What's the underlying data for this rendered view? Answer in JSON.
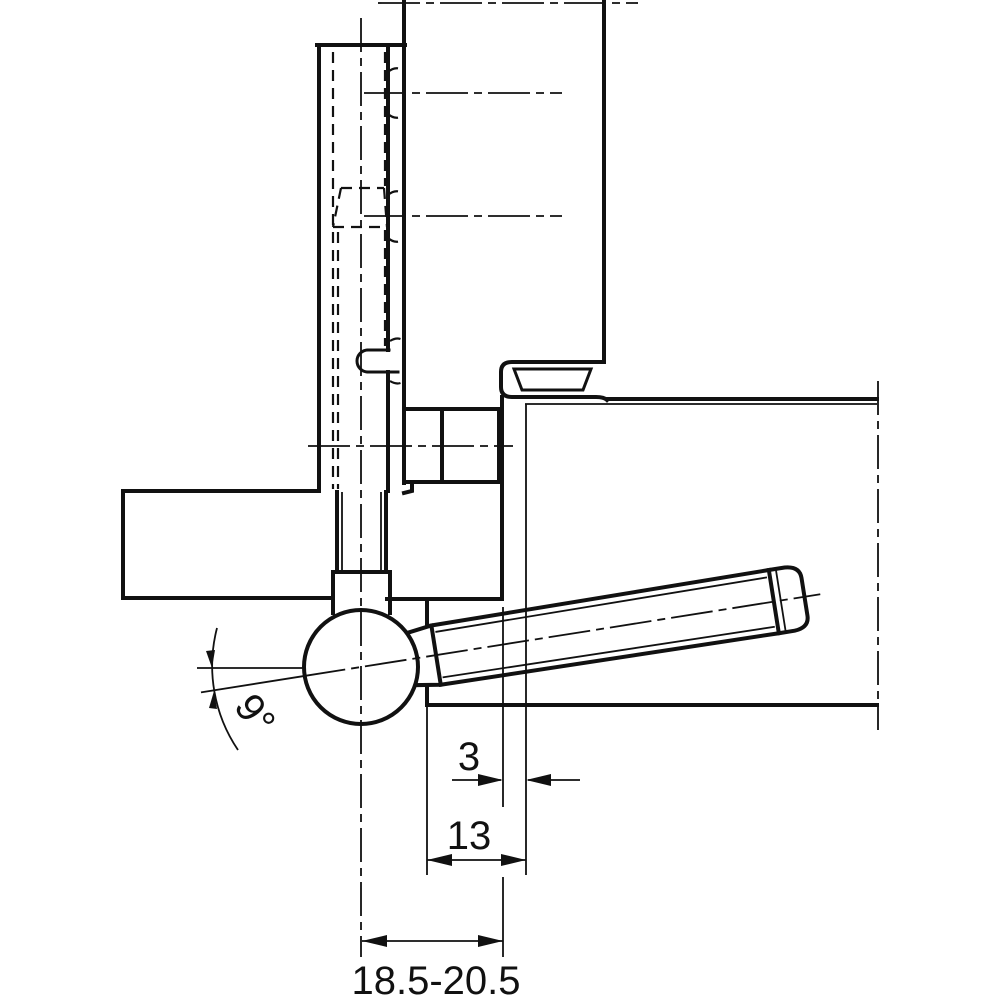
{
  "drawing": {
    "kind": "hinge-cross-section-technical-drawing",
    "colors": {
      "line": "#111111",
      "background": "#ffffff"
    },
    "dimensions": {
      "angle": {
        "label": "9°"
      },
      "offset": {
        "label": "3"
      },
      "depth": {
        "label": "13"
      },
      "range": {
        "label": "18.5-20.5"
      }
    }
  }
}
